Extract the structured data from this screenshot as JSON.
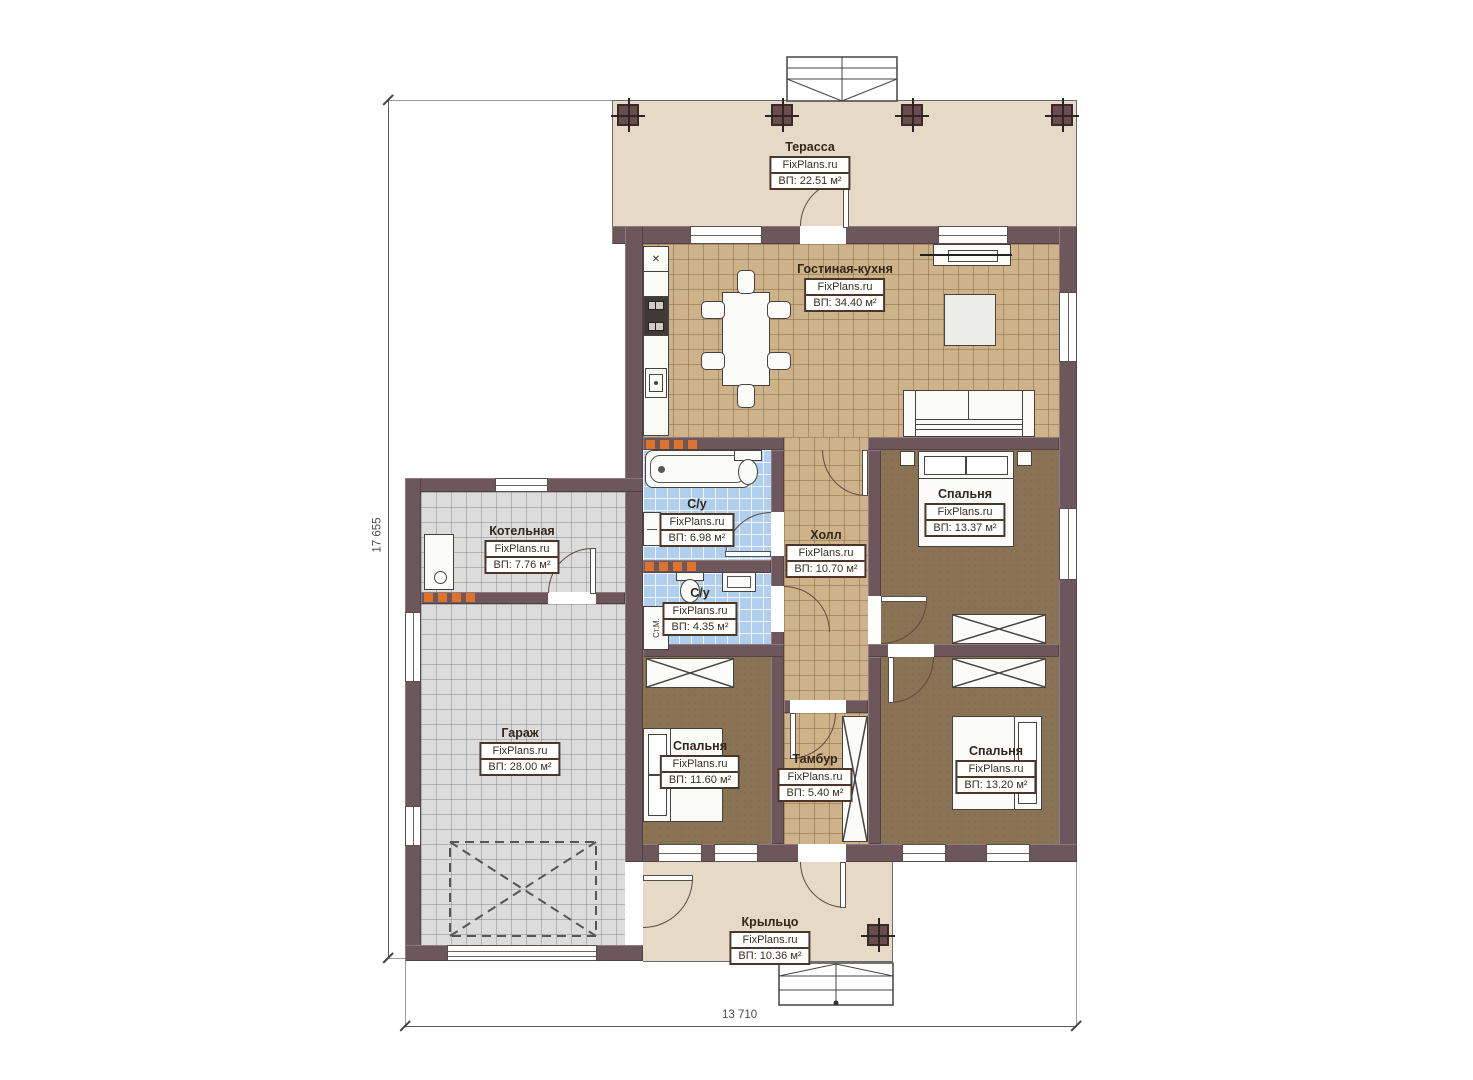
{
  "plan": {
    "brand": "FixPlans.ru",
    "dims": {
      "height": "17 655",
      "width": "13 710"
    },
    "icons": {
      "sink_cross": "✕"
    },
    "washer_label": "Ст.М.",
    "rooms": {
      "terrace": {
        "name": "Терасса",
        "area": "ВП: 22.51 м²"
      },
      "living_kitchen": {
        "name": "Гостиная-кухня",
        "area": "ВП: 34.40 м²"
      },
      "boiler": {
        "name": "Котельная",
        "area": "ВП: 7.76 м²"
      },
      "bathroom_big": {
        "name": "С/у",
        "area": "ВП: 6.98 м²"
      },
      "bathroom_small": {
        "name": "С/у",
        "area": "ВП: 4.35 м²"
      },
      "hall": {
        "name": "Холл",
        "area": "ВП: 10.70 м²"
      },
      "bedroom_top": {
        "name": "Спальня",
        "area": "ВП: 13.37 м²"
      },
      "bedroom_left": {
        "name": "Спальня",
        "area": "ВП: 11.60 м²"
      },
      "bedroom_right": {
        "name": "Спальня",
        "area": "ВП: 13.20 м²"
      },
      "tambour": {
        "name": "Тамбур",
        "area": "ВП: 5.40 м²"
      },
      "garage": {
        "name": "Гараж",
        "area": "ВП: 28.00 м²"
      },
      "porch": {
        "name": "Крыльцо",
        "area": "ВП: 10.36 м²"
      }
    },
    "colors": {
      "wall": "#6d575c",
      "floor_tan": "#cdb28a",
      "floor_brown": "#8a7254",
      "floor_blue": "#b0cfee",
      "floor_gray": "#dcdcdc",
      "floor_beige": "#e6d9c5",
      "radiator": "#e0732c"
    }
  }
}
